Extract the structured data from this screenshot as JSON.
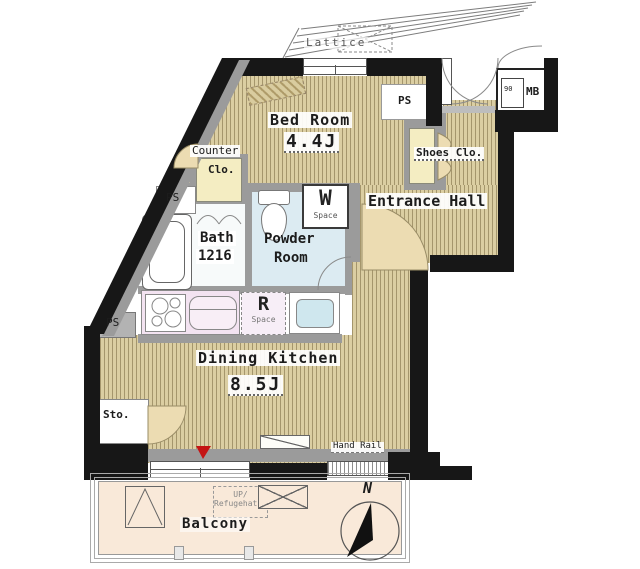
{
  "plan": {
    "rooms": {
      "bed": {
        "name": "Bed Room",
        "size": "4.4J"
      },
      "entrance": {
        "name": "Entrance Hall"
      },
      "bath": {
        "name": "Bath",
        "size": "1216"
      },
      "powder": {
        "line1": "Powder",
        "line2": "Room"
      },
      "dk": {
        "name": "Dining Kitchen",
        "size": "8.5J"
      },
      "balcony": {
        "name": "Balcony"
      }
    },
    "closets": {
      "counter": {
        "line1": "Counter",
        "line2": "Clo."
      },
      "shoes": {
        "label": "Shoes Clo."
      },
      "sto": {
        "label": "Sto."
      }
    },
    "utility": {
      "w": {
        "letter": "W",
        "word": "Space"
      },
      "r": {
        "letter": "R",
        "word": "Space"
      },
      "mb": {
        "label": "MB",
        "inner": "90"
      },
      "ps_top": "PS",
      "ps_mid": "PS",
      "ps_left": "PS"
    },
    "exterior": {
      "lattice": "Lattice",
      "hand_rail": "Hand Rail",
      "refuge": {
        "line1": "UP/",
        "line2": "Refugehatch"
      },
      "compass_north": "N"
    },
    "colors": {
      "wall_black": "#171717",
      "wall_gray": "#9b9b9b",
      "floor_tan": "#dbcea2",
      "floor_stripe": "#786740",
      "powder_blue": "#dcebf2",
      "kitchen_pink": "#f3e3f1",
      "closet_yellow": "#f4edc2",
      "balcony_peach": "#f9e9d9",
      "door_beige": "#ecdcb2",
      "marker_red": "#c41414"
    }
  }
}
